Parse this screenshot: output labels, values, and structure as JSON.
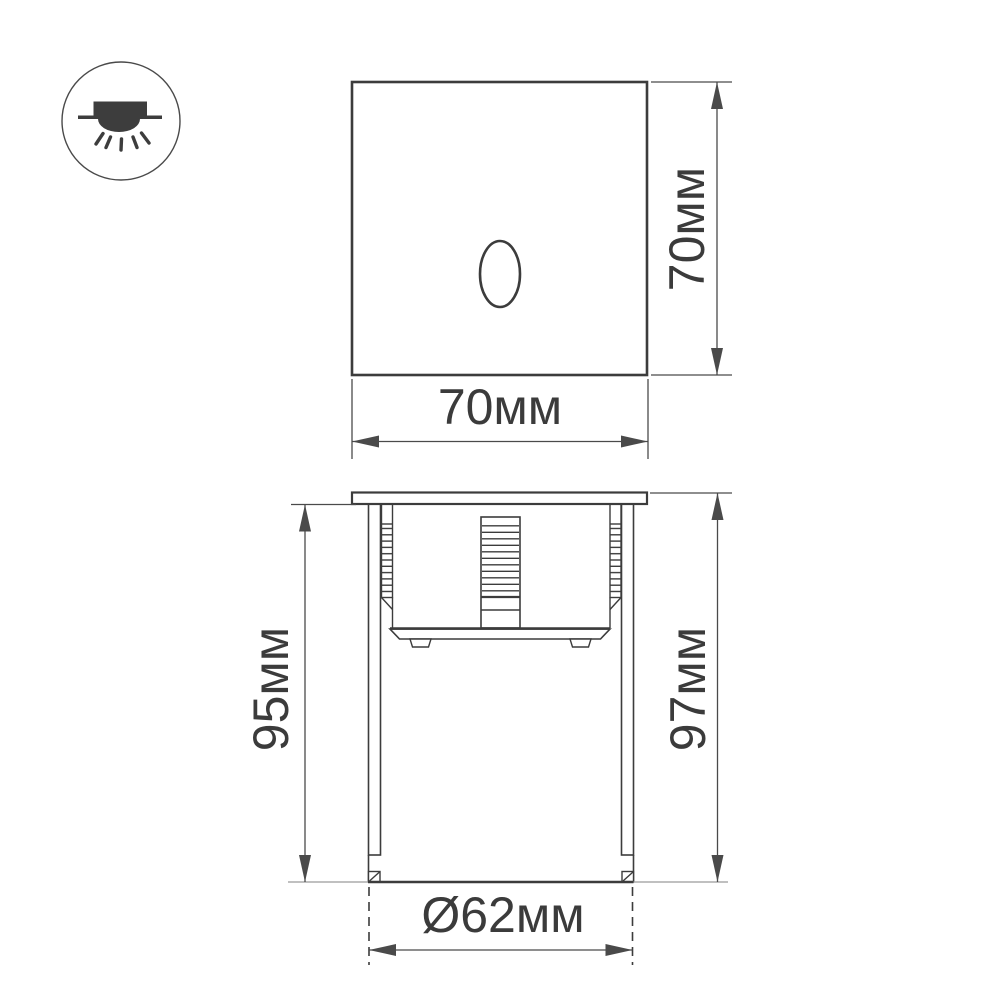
{
  "page": {
    "background": "#ffffff"
  },
  "colors": {
    "ink": "#3c3c3c",
    "dimension": "#4a4a4a",
    "label_text": "#3b3b3b",
    "surface_line": "#9b9b9b",
    "icon_glyph": "#3d3d3d",
    "icon_ring": "#4a4a4a"
  },
  "icon": {
    "type": "recessed-mount-downlight"
  },
  "dimensions": {
    "front_height": "70мм",
    "front_width": "70мм",
    "housing_depth": "95мм",
    "overall_depth": "97мм",
    "cutout_diameter": "Ø62мм"
  }
}
